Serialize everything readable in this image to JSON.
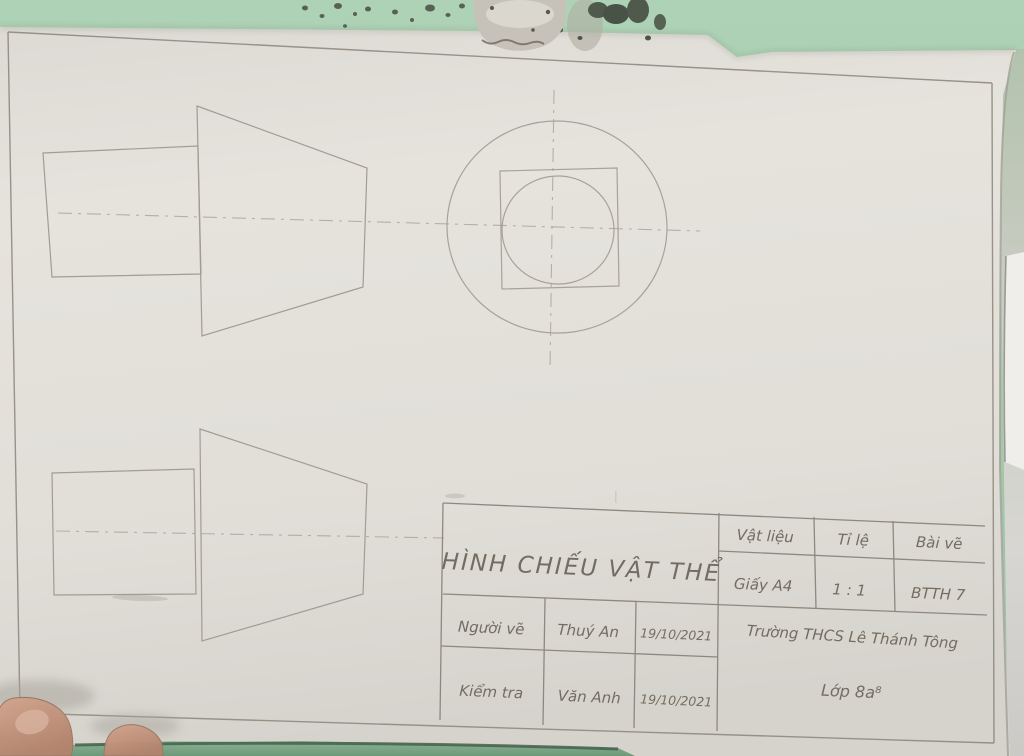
{
  "colors": {
    "wall_green": "#a6cbae",
    "wall_green_dark": "#7fa98a",
    "paper": "#e2dfd9",
    "pencil_line": "#8f897f",
    "handwriting": "#736c61",
    "skin": "#c79e89"
  },
  "title_block": {
    "title": "HÌNH CHIẾU VẬT THỂ",
    "material_label": "Vật liệu",
    "material_value": "Giấy A4",
    "scale_label": "Tỉ lệ",
    "scale_value": "1 : 1",
    "drawing_label": "Bài vẽ",
    "drawing_value": "BTTH 7",
    "drawn_by_label": "Người vẽ",
    "drawn_by_name": "Thuý An",
    "drawn_by_date": "19/10/2021",
    "checked_by_label": "Kiểm tra",
    "checked_by_name": "Văn Anh",
    "checked_by_date": "19/10/2021",
    "school": "Trường THCS Lê Thánh Tông",
    "class_name": "Lớp 8a⁸"
  }
}
